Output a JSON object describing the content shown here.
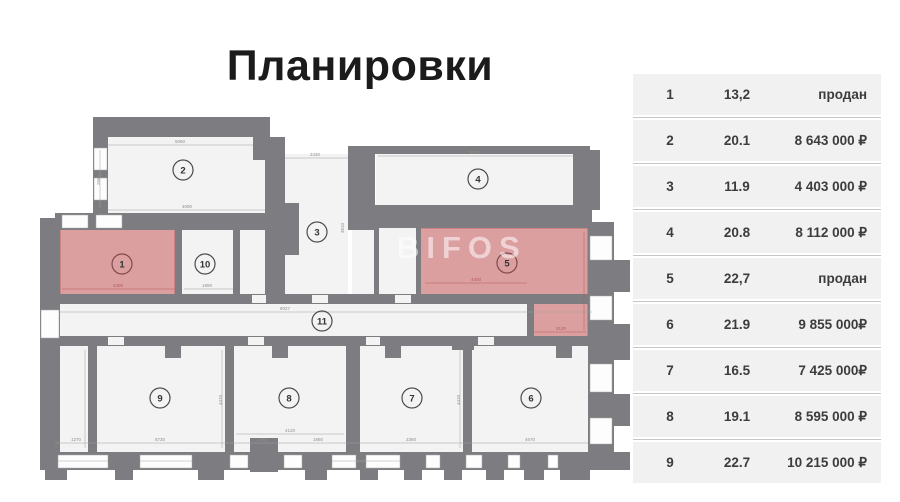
{
  "title": "Планировки",
  "colors": {
    "sold_fill": "#dc9fa0",
    "wall": "#7d7d81",
    "table_row_bg": "#f1f1f1"
  },
  "floorplan": {
    "watermark": "BIFOS",
    "rooms": [
      {
        "number": "1",
        "sold": true,
        "x": 60,
        "y": 228,
        "w": 115,
        "h": 68,
        "cx": 122,
        "cy": 264
      },
      {
        "number": "2",
        "sold": false,
        "x": 108,
        "y": 137,
        "w": 157,
        "h": 76,
        "cx": 183,
        "cy": 170
      },
      {
        "number": "3",
        "sold": false,
        "x": 285,
        "y": 154,
        "w": 63,
        "h": 140,
        "cx": 317,
        "cy": 232
      },
      {
        "number": "4",
        "sold": false,
        "x": 376,
        "y": 154,
        "w": 197,
        "h": 51,
        "cx": 478,
        "cy": 179
      },
      {
        "number": "5",
        "sold": true,
        "points": "420,228 588,228 588,337 532,337 532,296 420,296",
        "cx": 507,
        "cy": 263
      },
      {
        "number": "6",
        "sold": false,
        "x": 472,
        "y": 346,
        "w": 116,
        "h": 106,
        "cx": 531,
        "cy": 398
      },
      {
        "number": "7",
        "sold": false,
        "x": 355,
        "y": 346,
        "w": 108,
        "h": 106,
        "cx": 412,
        "cy": 398
      },
      {
        "number": "8",
        "sold": false,
        "x": 234,
        "y": 346,
        "w": 112,
        "h": 106,
        "cx": 289,
        "cy": 398
      },
      {
        "number": "9",
        "sold": false,
        "x": 97,
        "y": 346,
        "w": 128,
        "h": 106,
        "cx": 160,
        "cy": 398
      },
      {
        "number": "10",
        "sold": false,
        "x": 182,
        "y": 230,
        "w": 51,
        "h": 66,
        "cx": 205,
        "cy": 264
      },
      {
        "number": "11",
        "sold": false,
        "points": "60,304 527,304 527,336 88,336 88,452 60,452",
        "cx": 322,
        "cy": 321
      }
    ],
    "dimensions": [
      {
        "t": "5060",
        "x": 180,
        "y": 143
      },
      {
        "t": "2660",
        "x": 100,
        "y": 180,
        "rot": true
      },
      {
        "t": "4090",
        "x": 187,
        "y": 208
      },
      {
        "t": "2430",
        "x": 315,
        "y": 156
      },
      {
        "t": "3610",
        "x": 344,
        "y": 228,
        "rot": true
      },
      {
        "t": "3700",
        "x": 475,
        "y": 154
      },
      {
        "t": "4400",
        "x": 118,
        "y": 287,
        "red": true
      },
      {
        "t": "1890",
        "x": 207,
        "y": 287
      },
      {
        "t": "8027",
        "x": 285,
        "y": 310
      },
      {
        "t": "4400",
        "x": 476,
        "y": 281,
        "red": true
      },
      {
        "t": "2120",
        "x": 561,
        "y": 330,
        "red": true
      },
      {
        "t": "1270",
        "x": 76,
        "y": 441
      },
      {
        "t": "5730",
        "x": 160,
        "y": 441
      },
      {
        "t": "1848",
        "x": 262,
        "y": 441
      },
      {
        "t": "1860",
        "x": 318,
        "y": 441
      },
      {
        "t": "4120",
        "x": 290,
        "y": 432
      },
      {
        "t": "2360",
        "x": 411,
        "y": 441
      },
      {
        "t": "4670",
        "x": 530,
        "y": 441
      },
      {
        "t": "4410",
        "x": 222,
        "y": 400,
        "rot": true
      },
      {
        "t": "4410",
        "x": 460,
        "y": 400,
        "rot": true
      }
    ]
  },
  "table": {
    "rows": [
      {
        "num": "1",
        "area": "13,2",
        "price": "продан"
      },
      {
        "num": "2",
        "area": "20.1",
        "price": "8 643 000 ₽"
      },
      {
        "num": "3",
        "area": "11.9",
        "price": "4 403 000 ₽"
      },
      {
        "num": "4",
        "area": "20.8",
        "price": "8 112 000 ₽"
      },
      {
        "num": "5",
        "area": "22,7",
        "price": "продан"
      },
      {
        "num": "6",
        "area": "21.9",
        "price": "9 855 000₽"
      },
      {
        "num": "7",
        "area": "16.5",
        "price": "7 425 000₽"
      },
      {
        "num": "8",
        "area": "19.1",
        "price": "8 595 000 ₽"
      },
      {
        "num": "9",
        "area": "22.7",
        "price": "10 215 000 ₽"
      }
    ]
  }
}
